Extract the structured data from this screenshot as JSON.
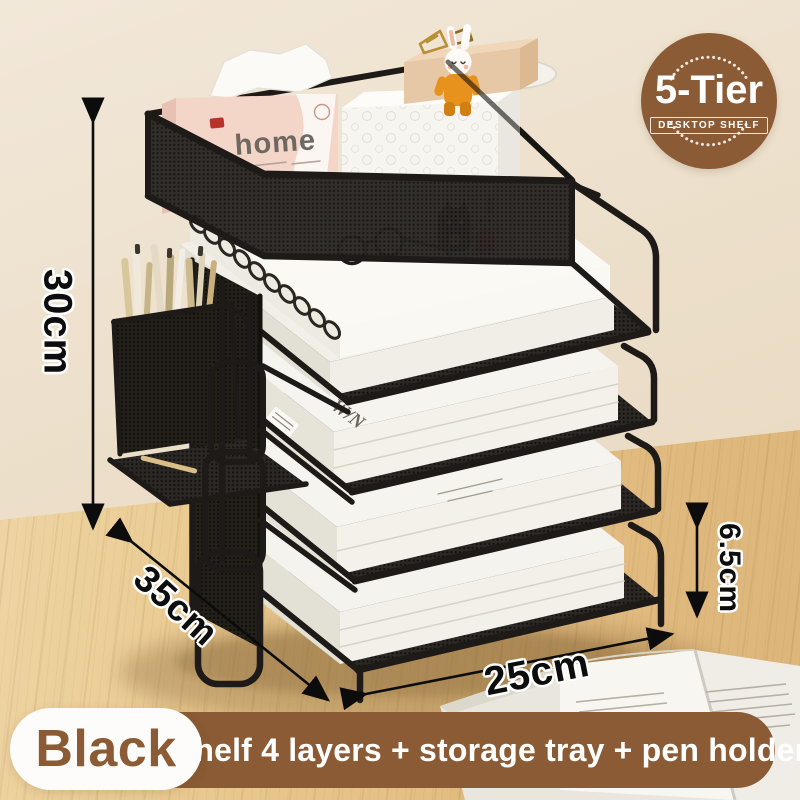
{
  "badge": {
    "title": "5-Tier",
    "subtitle": "DESKTOP SHELF"
  },
  "dimensions": {
    "height": "30cm",
    "depth": "35cm",
    "width": "25cm",
    "layer_height": "6.5cm"
  },
  "banner": {
    "color_name": "Black",
    "description": "Shelf 4 layers + storage tray + pen holder"
  },
  "props": {
    "tissue_box_text": "home",
    "magazine_spine_text": "W/N"
  },
  "colors": {
    "brand_brown": "#8a5b34",
    "wall_beige": "#ece0cc",
    "desk_wood": "#e5c38c",
    "metal_black": "#211e1b",
    "tissue_pink": "#f4d6c8"
  }
}
